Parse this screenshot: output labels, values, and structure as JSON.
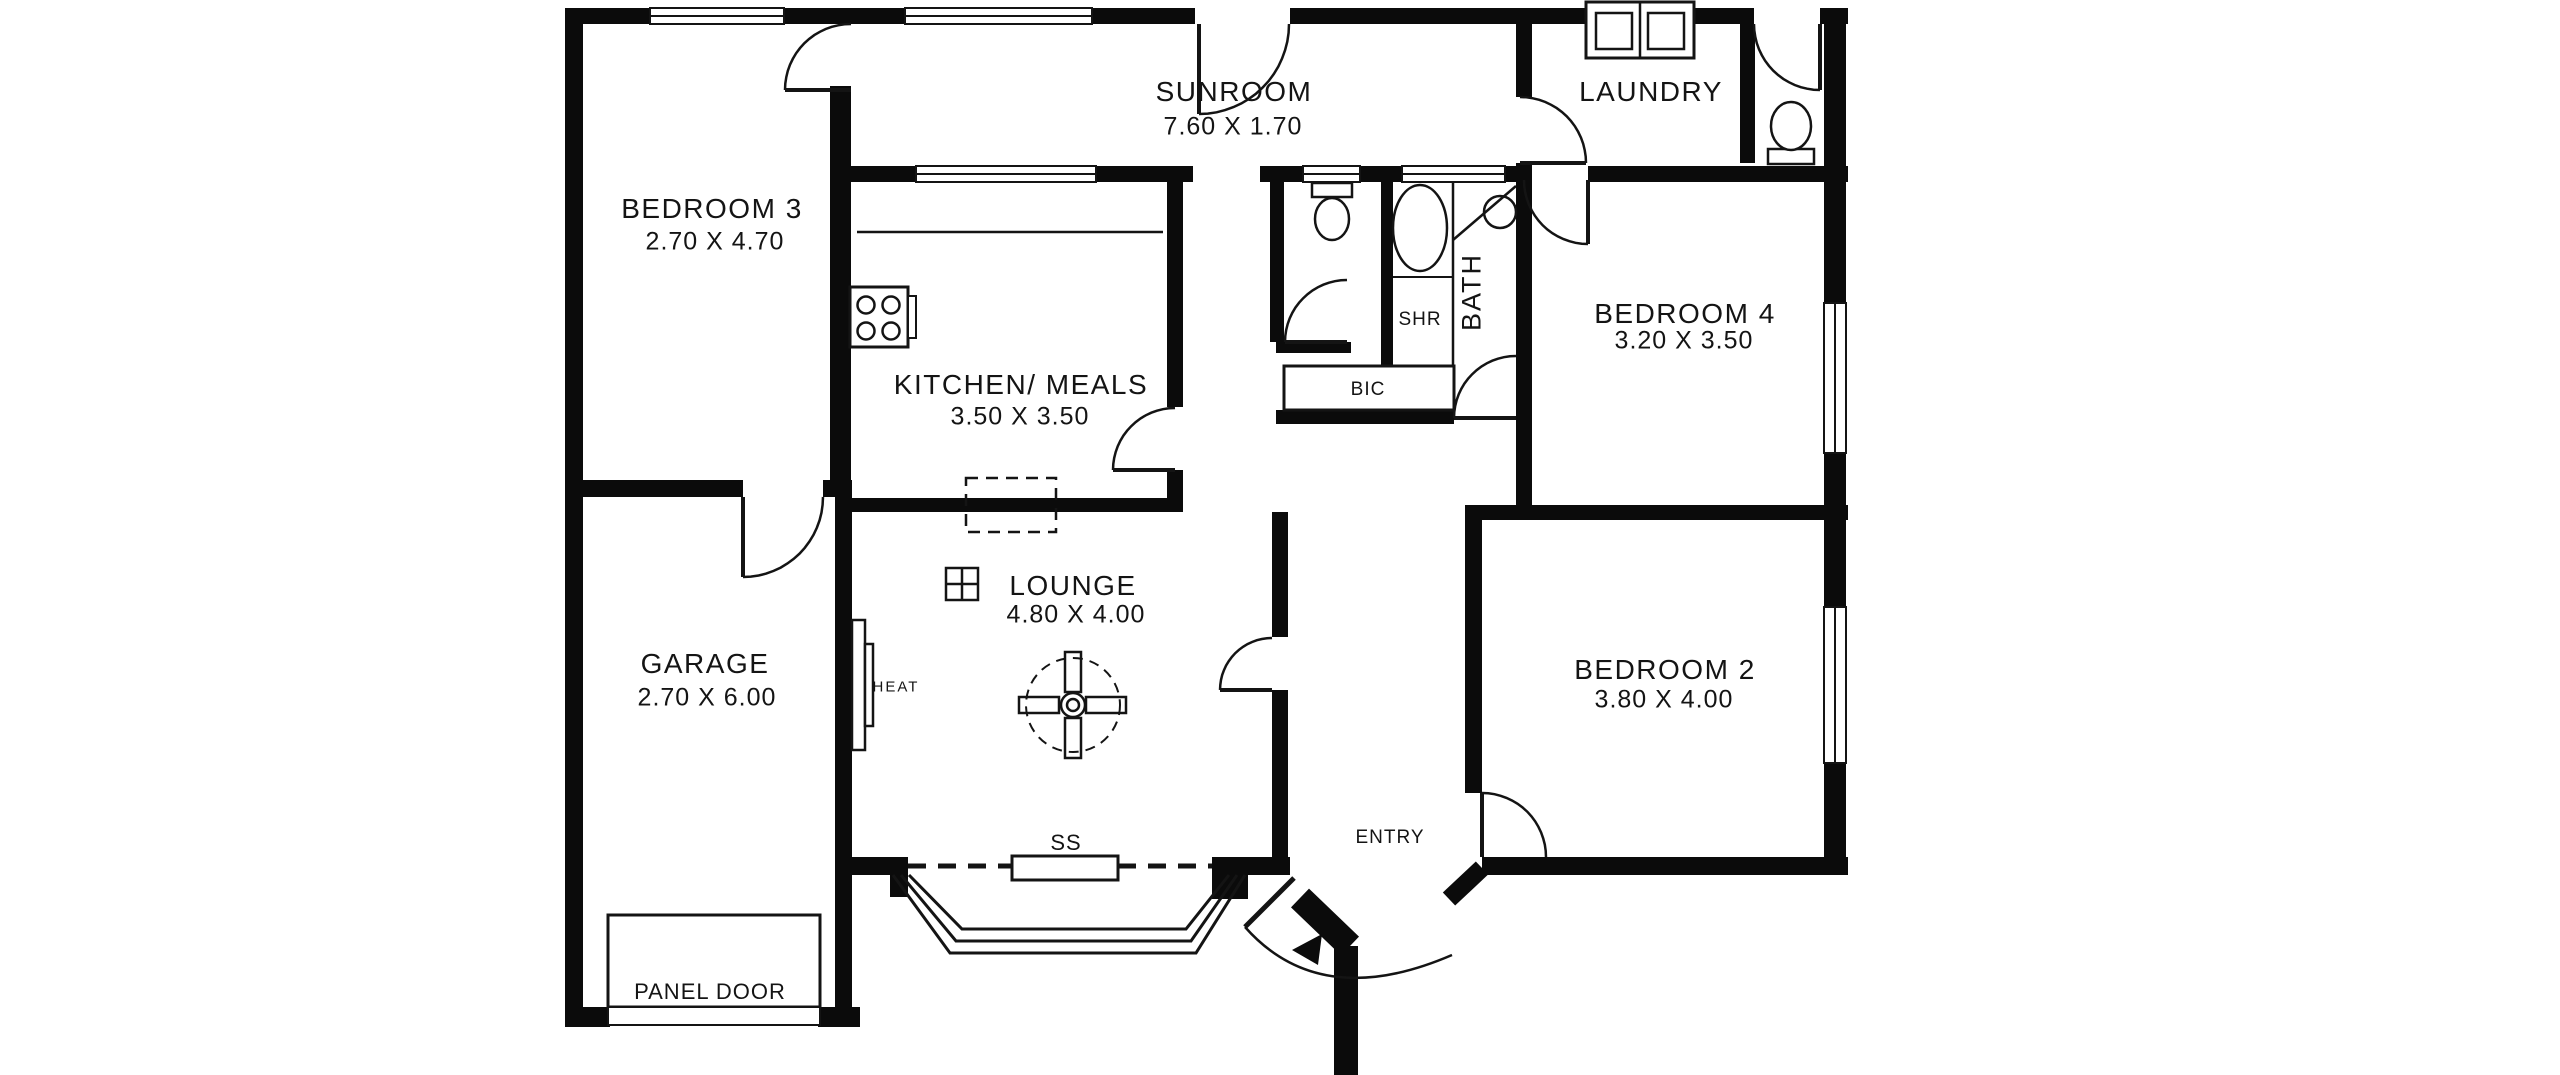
{
  "title": "Floor plan",
  "rooms": {
    "sunroom": {
      "name": "SUNROOM",
      "dims": "7.60 X 1.70"
    },
    "laundry": {
      "name": "LAUNDRY",
      "dims": ""
    },
    "bedroom3": {
      "name": "BEDROOM 3",
      "dims": "2.70 X 4.70"
    },
    "kitchen": {
      "name": "KITCHEN/ MEALS",
      "dims": "3.50 X 3.50"
    },
    "bedroom4": {
      "name": "BEDROOM 4",
      "dims": "3.20 X 3.50"
    },
    "garage": {
      "name": "GARAGE",
      "dims": "2.70 X 6.00"
    },
    "lounge": {
      "name": "LOUNGE",
      "dims": "4.80 X 4.00"
    },
    "bedroom2": {
      "name": "BEDROOM 2",
      "dims": "3.80 X 4.00"
    },
    "entry": {
      "name": "ENTRY",
      "dims": ""
    }
  },
  "annotations": {
    "bath": "BATH",
    "shower": "SHR",
    "built_in_cupboard": "BIC",
    "sliding_sash": "SS",
    "heater": "HEAT",
    "panel_door": "PANEL DOOR"
  },
  "colors": {
    "wall": "#0b0b0b",
    "line": "#141414",
    "background": "#ffffff",
    "text": "#141414"
  }
}
